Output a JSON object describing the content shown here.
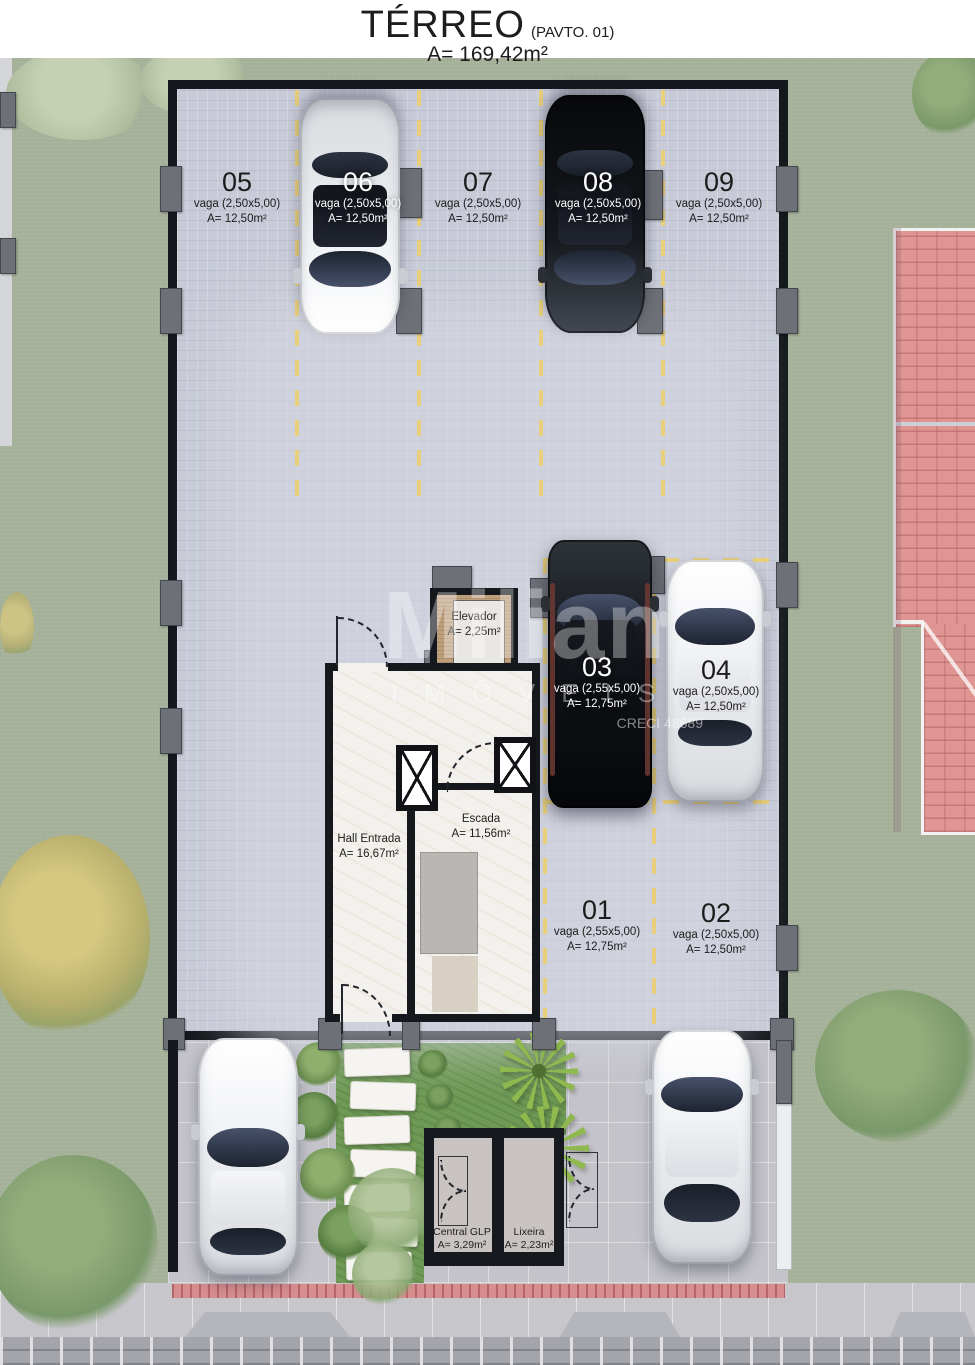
{
  "header": {
    "title": "TÉRREO",
    "pavto": "(PAVTO. 01)",
    "area": "A= 169,42m²"
  },
  "watermark": {
    "brand": "Milian",
    "line2": "IMÓVEIS",
    "creci": "CRECI 48689"
  },
  "rooms": {
    "elevador": {
      "name": "Elevador",
      "area": "A= 2,25m²"
    },
    "escada": {
      "name": "Escada",
      "area": "A= 11,56m²"
    },
    "hall": {
      "name": "Hall Entrada",
      "area": "A= 16,67m²"
    },
    "central_glp": {
      "name": "Central GLP",
      "area": "A= 3,29m²"
    },
    "lixeira": {
      "name": "Lixeira",
      "area": "A= 2,23m²"
    }
  },
  "spots": [
    {
      "num": "05",
      "dim": "vaga (2,50x5,00)",
      "area": "A= 12,50m²"
    },
    {
      "num": "06",
      "dim": "vaga (2,50x5,00)",
      "area": "A= 12,50m²"
    },
    {
      "num": "07",
      "dim": "vaga (2,50x5,00)",
      "area": "A= 12,50m²"
    },
    {
      "num": "08",
      "dim": "vaga (2,50x5,00)",
      "area": "A= 12,50m²"
    },
    {
      "num": "09",
      "dim": "vaga (2,50x5,00)",
      "area": "A= 12,50m²"
    },
    {
      "num": "03",
      "dim": "vaga (2,55x5,00)",
      "area": "A= 12,75m²"
    },
    {
      "num": "04",
      "dim": "vaga (2,50x5,00)",
      "area": "A= 12,50m²"
    },
    {
      "num": "01",
      "dim": "vaga (2,55x5,00)",
      "area": "A= 12,75m²"
    },
    {
      "num": "02",
      "dim": "vaga (2,50x5,00)",
      "area": "A= 12,50m²"
    }
  ],
  "colors": {
    "grass": "#a7b29b",
    "pavement": "#c8cbd7",
    "wall": "#15181c",
    "lane_yellow": "#e7cf7c",
    "roof_tile": "#de9592",
    "lawn": "#6f9a55",
    "red_strip": "#d68d8e",
    "marble": "#f3f1ed"
  }
}
